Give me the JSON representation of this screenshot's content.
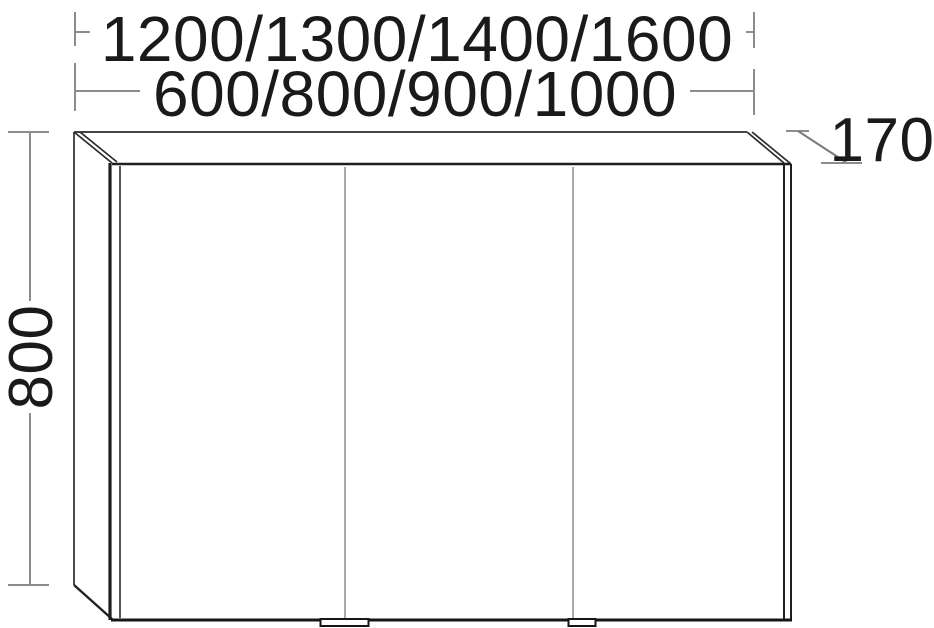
{
  "figure": {
    "type": "furniture-dimension-drawing",
    "view": "front elevation with oblique depth",
    "doors": 3
  },
  "dimensions": {
    "width_row1": "1200/1300/1400/1600",
    "width_row2": "600/800/900/1000",
    "height": "800",
    "depth": "170"
  },
  "colors": {
    "background": "#ffffff",
    "outline": "#2b2b2b",
    "outline_heavy": "#161616",
    "dimension_line": "#8c8c8c",
    "seam_line": "#a0a0a0",
    "text": "#1a1a1a"
  }
}
